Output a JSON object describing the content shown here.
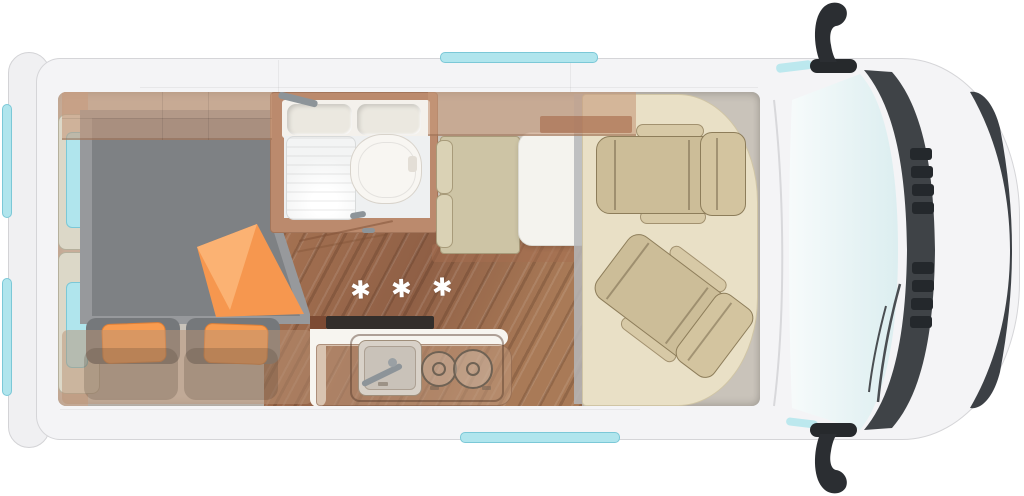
{
  "floorplan": {
    "marker_symbol": "✱ ✱ ✱"
  },
  "colors": {
    "van_body": "#f4f4f6",
    "body_outline": "#d5d5d8",
    "window_glass": "#b0e5ed",
    "window_frame": "#7bc8d7",
    "wood_floor": "#9c6b4d",
    "cabinet_wood": "#bb8a6d",
    "mattress_gray": "#7e8184",
    "accent_orange": "#f89c50",
    "upholstery_beige": "#ccbd98",
    "cab_mat": "#e9e0c6",
    "dark_trim": "#3f4347",
    "bathroom_white": "#eef0f1"
  },
  "areas": [
    "rear-bed",
    "rear-door-windows",
    "bathroom",
    "shower-tray",
    "toilet",
    "washbasin-shelf",
    "kitchen-unit",
    "kitchen-sink",
    "two-burner-hob",
    "heating-marker",
    "dinette-bench",
    "dinette-table",
    "cab-floor-mat",
    "swivel-seat-front",
    "swivel-seat-rear",
    "windshield",
    "front-grille",
    "side-mirror-left",
    "side-mirror-right",
    "roof-window-strips"
  ]
}
